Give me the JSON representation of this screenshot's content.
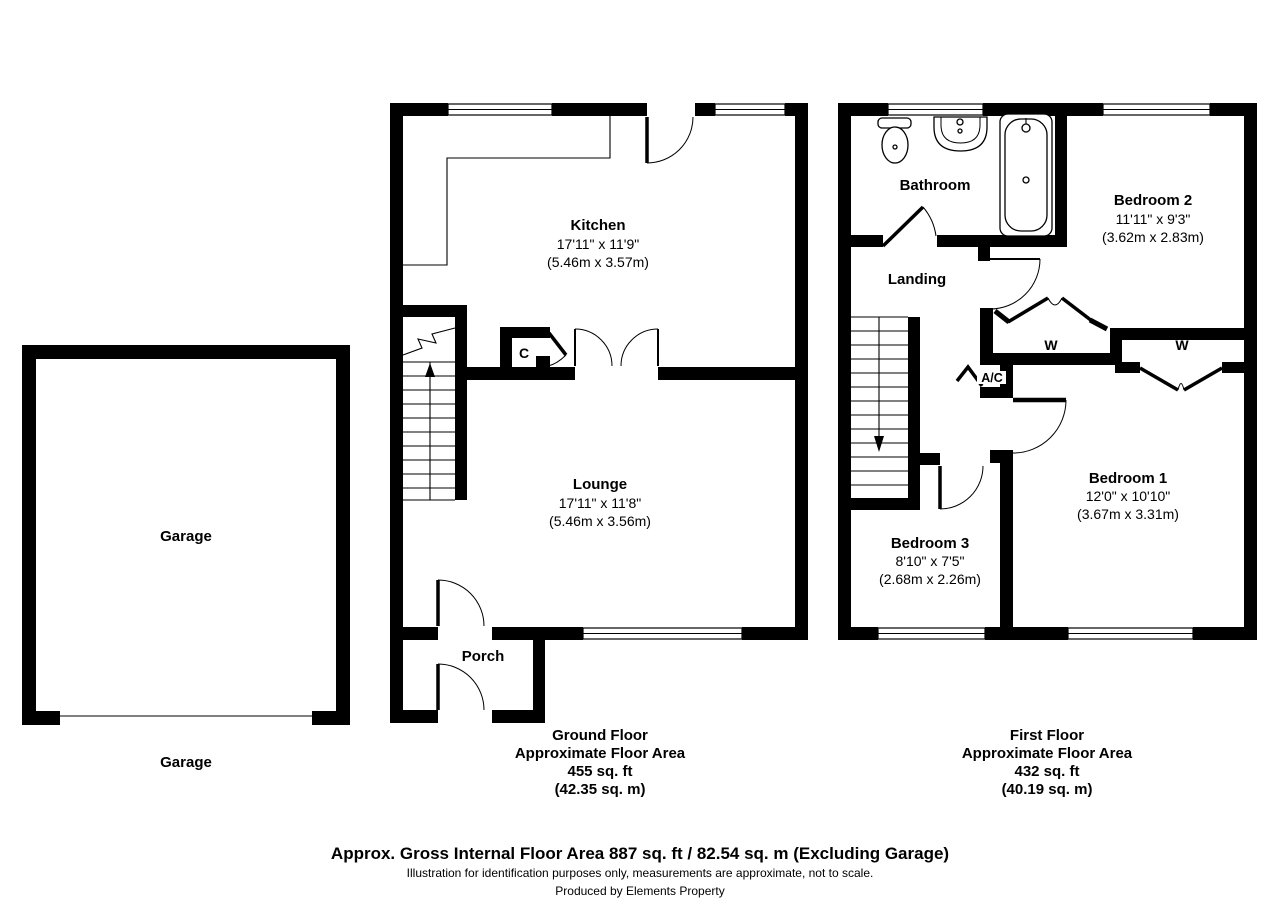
{
  "garage": {
    "label": "Garage",
    "caption": "Garage"
  },
  "ground": {
    "kitchen": {
      "name": "Kitchen",
      "imp": "17'11\" x 11'9\"",
      "met": "(5.46m x 3.57m)"
    },
    "lounge": {
      "name": "Lounge",
      "imp": "17'11\" x 11'8\"",
      "met": "(5.46m x 3.56m)"
    },
    "porch": {
      "name": "Porch"
    },
    "cupboard": {
      "label": "C"
    },
    "caption": {
      "l1": "Ground Floor",
      "l2": "Approximate Floor Area",
      "l3": "455 sq. ft",
      "l4": "(42.35 sq. m)"
    }
  },
  "first": {
    "bathroom": {
      "name": "Bathroom"
    },
    "landing": {
      "name": "Landing"
    },
    "bedroom2": {
      "name": "Bedroom 2",
      "imp": "11'11\" x 9'3\"",
      "met": "(3.62m x 2.83m)"
    },
    "bedroom1": {
      "name": "Bedroom 1",
      "imp": "12'0\" x 10'10\"",
      "met": "(3.67m x 3.31m)"
    },
    "bedroom3": {
      "name": "Bedroom 3",
      "imp": "8'10\" x 7'5\"",
      "met": "(2.68m x 2.26m)"
    },
    "wardrobe_left": {
      "label": "W"
    },
    "wardrobe_right": {
      "label": "W"
    },
    "airing": {
      "label": "A/C"
    },
    "caption": {
      "l1": "First Floor",
      "l2": "Approximate Floor Area",
      "l3": "432 sq. ft",
      "l4": "(40.19 sq. m)"
    }
  },
  "footer": {
    "gross": "Approx. Gross Internal Floor Area 887 sq. ft / 82.54 sq. m (Excluding Garage)",
    "disclaimer": "Illustration for identification purposes only, measurements are approximate, not to scale.",
    "produced_by": "Produced by Elements Property"
  },
  "colors": {
    "wall": "#000000",
    "background": "#ffffff"
  }
}
